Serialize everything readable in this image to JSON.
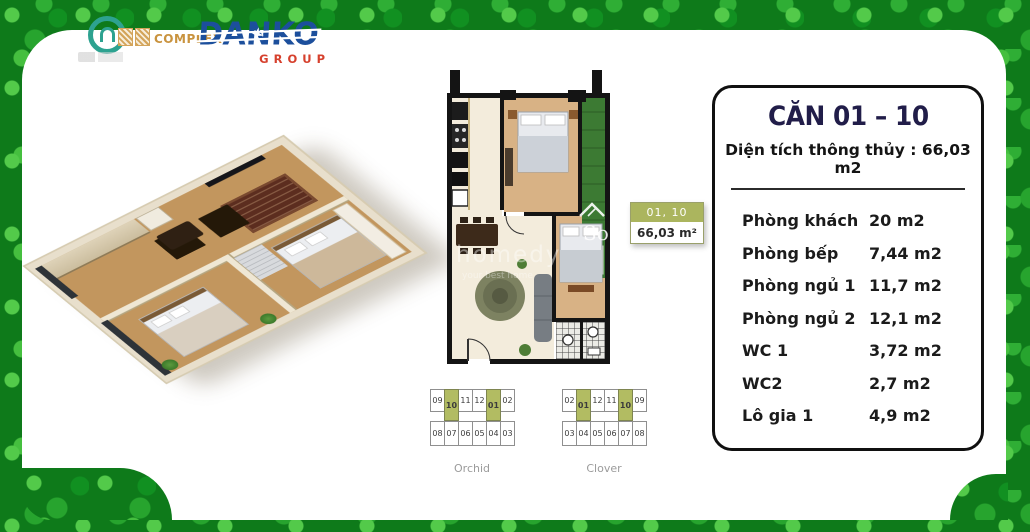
{
  "header": {
    "project": {
      "text": "COMPLEX"
    },
    "danko": {
      "name": "DANKO",
      "sub": "GROUP"
    }
  },
  "badge": {
    "units": "01, 10",
    "area": "66,03 m²"
  },
  "panel": {
    "title": "CĂN 01 – 10",
    "total_area": "Diện tích thông thủy : 66,03 m2",
    "rooms": [
      {
        "label": "Phòng khách",
        "area": "20 m2"
      },
      {
        "label": "Phòng bếp",
        "area": "7,44 m2"
      },
      {
        "label": "Phòng ngủ 1",
        "area": "11,7 m2"
      },
      {
        "label": "Phòng ngủ 2",
        "area": "12,1 m2"
      },
      {
        "label": "WC 1",
        "area": "3,72 m2"
      },
      {
        "label": "WC2",
        "area": "2,7 m2"
      },
      {
        "label": "Lô gia 1",
        "area": "4,9 m2"
      }
    ]
  },
  "keyplans": [
    {
      "name": "Orchid",
      "top_row": [
        "09",
        "10",
        "11",
        "12",
        "01",
        "02"
      ],
      "bottom_row": [
        "08",
        "07",
        "06",
        "05",
        "04",
        "03"
      ],
      "highlighted": [
        "10",
        "01"
      ]
    },
    {
      "name": "Clover",
      "top_row": [
        "02",
        "01",
        "12",
        "11",
        "10",
        "09"
      ],
      "bottom_row": [
        "03",
        "04",
        "05",
        "06",
        "07",
        "08"
      ],
      "highlighted": [
        "01",
        "10"
      ]
    }
  ],
  "watermark": {
    "line1": "homedy",
    "line2": "your best home",
    "logo": "So"
  },
  "colors": {
    "clover_green": "#1d9428",
    "olive": "#b0ba60",
    "navy": "#211d49",
    "danko_blue": "#1c4f9c",
    "danko_red": "#d6402d",
    "gold": "#c9933f",
    "balcony_green": "#3c7a33"
  }
}
